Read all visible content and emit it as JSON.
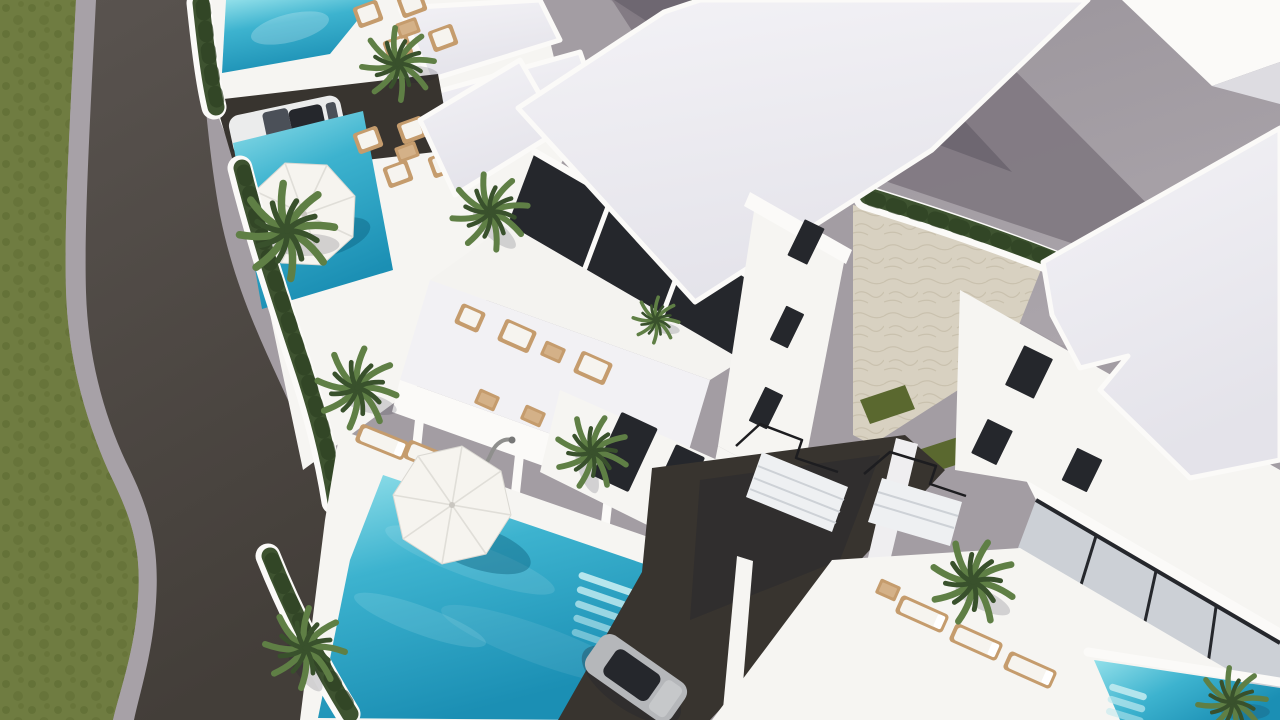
{
  "scene": {
    "type": "3d-architectural-render",
    "view": "aerial-oblique",
    "description": "Photorealistic CGI aerial view of a modern white villa complex with private turquoise pools, rattan outdoor furniture, palm trees, hedges and a curved asphalt access road bordered by a grass verge",
    "time_of_day": "day",
    "lighting": "bright sun, soft shadows cast toward lower-right"
  },
  "palette": {
    "ground_gray": "#a39da3",
    "street_shadow": "#6e6771",
    "street_shadow2": "#7f7881",
    "dark_slate": "#566070",
    "paper_white": "#fbfaf8",
    "wall_white": "#f6f5f2",
    "wall_shade": "#dddce1",
    "roof_hi": "#f3f2f6",
    "roof_lo": "#e4e3ea",
    "glass_dark": "#25272c",
    "glass_mid": "#4b5058",
    "glass_light": "#ccd0d6",
    "asphalt_top": "#59534f",
    "asphalt_bot": "#433e39",
    "asphalt_dark": "#38342f",
    "sidewalk": "#a7a1a7",
    "grass": "#6f7c41",
    "grass_dark": "#5a682f",
    "hedge": "#3e5330",
    "hedge_dark": "#2c3f22",
    "palm": "#5f7f45",
    "palm_deep": "#39512c",
    "pool_light": "#93e0ea",
    "pool_mid": "#3db3cf",
    "pool_deep": "#1b8fb4",
    "stone": "#d8d1c1",
    "stone_line": "#c6bda9",
    "wicker": "#c59c6d",
    "cushion": "#f6f4ef",
    "car_white": "#ebecec",
    "car_silver": "#b5b7ba",
    "shadow_color": "rgba(30,32,48,0.30)",
    "water_shadow": "rgba(10,90,120,0.40)"
  },
  "inventory": {
    "villas": {
      "count": 4,
      "style": "white flat-roof modern, two storeys, stair towers with small dark windows"
    },
    "pools": {
      "count": 4,
      "shape": "rectangular with roman step entries",
      "water": "turquoise"
    },
    "umbrellas": {
      "count": 2,
      "shape": "octagonal cantilever",
      "color": "white"
    },
    "cars": [
      {
        "color": "white",
        "location": "upper-left driveway beside pools"
      },
      {
        "color": "silver",
        "location": "lower central driveway between villas"
      }
    ],
    "palm_trees": {
      "count": 9
    },
    "outdoor_furniture": {
      "material": "rattan/wicker",
      "cushions": "white",
      "pieces": "sofas, armchairs, coffee tables, sun loungers"
    },
    "road": {
      "surface": "asphalt",
      "curved": true,
      "position": "left edge",
      "sidewalk": "light gray",
      "verge": "grass"
    },
    "hedges": {
      "location": "along road, gardens and courtyard",
      "color": "dark green"
    },
    "courtyard": {
      "surface": "beige natural stone paving"
    },
    "staircases": {
      "count": 2,
      "railing": "thin black metal"
    }
  }
}
